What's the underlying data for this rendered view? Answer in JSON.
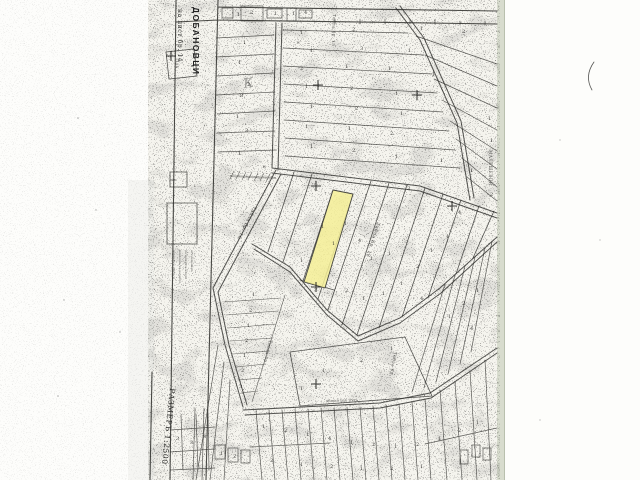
{
  "map": {
    "region_label": "ДОБАНОВЦИ",
    "sheet_label": "на лист бр. 14",
    "scale_label": "РАЗМЕРЪ 1:2500",
    "neighbor_label": "МАЛЕШЕВЦИ",
    "road_label": "общински пъть",
    "benchmark_label": "1484",
    "handwritten_mark": "К",
    "highlight_color": "#f4ef97",
    "highlight_stroke": "#44443e",
    "paper_color": "#f5f4ee",
    "scan_edge_color": "#d8dcce",
    "ink_color": "#2b2b28",
    "block_labels": [
      {
        "t": "Табла бр. 15",
        "x": 333,
        "y": 14,
        "r": 92,
        "s": 4.2
      },
      {
        "t": "Табла бр. 16",
        "x": 254,
        "y": 206,
        "r": 117,
        "s": 4.8
      },
      {
        "t": "Табла бр. 18",
        "x": 377,
        "y": 222,
        "r": 107,
        "s": 4.8
      },
      {
        "t": "Табла бр.",
        "x": 269,
        "y": 340,
        "r": 103,
        "s": 4.2
      },
      {
        "t": "Табла бр.",
        "x": 394,
        "y": 352,
        "r": 100,
        "s": 4.2
      }
    ],
    "legend_note_lines": [
      "планътъ е снетъ и",
      "нанесенъ въ размѣръ",
      "по межди и имоти",
      "отъ земемѣра"
    ],
    "crosses": [
      [
        318,
        85
      ],
      [
        417,
        95
      ],
      [
        316,
        186
      ],
      [
        316,
        287
      ],
      [
        316,
        384
      ],
      [
        171,
        56
      ],
      [
        452,
        206
      ]
    ],
    "parcel_numbers": [
      [
        300,
        34,
        "1"
      ],
      [
        352,
        31,
        "2"
      ],
      [
        420,
        30,
        "1"
      ],
      [
        462,
        33,
        "2"
      ],
      [
        310,
        52,
        "1"
      ],
      [
        360,
        50,
        "3"
      ],
      [
        408,
        52,
        "1"
      ],
      [
        300,
        70,
        "2"
      ],
      [
        345,
        68,
        "1"
      ],
      [
        388,
        70,
        "1"
      ],
      [
        432,
        76,
        "1"
      ],
      [
        305,
        88,
        "1"
      ],
      [
        350,
        90,
        "2"
      ],
      [
        395,
        95,
        "1"
      ],
      [
        310,
        108,
        "1"
      ],
      [
        355,
        110,
        "2"
      ],
      [
        400,
        115,
        "1"
      ],
      [
        305,
        128,
        "1"
      ],
      [
        348,
        130,
        "1"
      ],
      [
        390,
        135,
        "2"
      ],
      [
        310,
        148,
        "1"
      ],
      [
        352,
        152,
        "2"
      ],
      [
        395,
        158,
        "1"
      ],
      [
        440,
        162,
        "1"
      ],
      [
        470,
        172,
        "1"
      ],
      [
        488,
        120,
        "1"
      ],
      [
        490,
        142,
        "1"
      ],
      [
        407,
        190,
        "3"
      ],
      [
        490,
        196,
        "2"
      ],
      [
        458,
        214,
        "4"
      ],
      [
        243,
        44,
        "1"
      ],
      [
        238,
        64,
        "1"
      ],
      [
        247,
        86,
        "2"
      ],
      [
        240,
        97,
        "8"
      ],
      [
        236,
        118,
        "1"
      ],
      [
        245,
        132,
        "3"
      ],
      [
        238,
        155,
        "1"
      ],
      [
        237,
        16,
        "1"
      ],
      [
        250,
        14,
        "2"
      ],
      [
        274,
        15,
        "1"
      ],
      [
        292,
        15,
        "1"
      ],
      [
        304,
        14,
        "4"
      ],
      [
        344,
        225,
        "1"
      ],
      [
        332,
        245,
        "1"
      ],
      [
        358,
        242,
        "4"
      ],
      [
        370,
        260,
        "1"
      ],
      [
        388,
        255,
        "1"
      ],
      [
        345,
        292,
        "2"
      ],
      [
        362,
        300,
        "1"
      ],
      [
        382,
        295,
        "1"
      ],
      [
        400,
        285,
        "1"
      ],
      [
        416,
        268,
        "2"
      ],
      [
        430,
        252,
        "1"
      ],
      [
        446,
        238,
        "1"
      ],
      [
        420,
        300,
        "4"
      ],
      [
        300,
        262,
        "1"
      ],
      [
        321,
        228,
        "1"
      ],
      [
        252,
        296,
        "1"
      ],
      [
        249,
        312,
        "2"
      ],
      [
        247,
        327,
        "1"
      ],
      [
        245,
        342,
        "2"
      ],
      [
        243,
        357,
        "1"
      ],
      [
        241,
        372,
        "2"
      ],
      [
        239,
        388,
        "3"
      ],
      [
        322,
        372,
        "1"
      ],
      [
        360,
        362,
        "2"
      ],
      [
        300,
        390,
        "1"
      ],
      [
        390,
        350,
        "1"
      ],
      [
        448,
        318,
        "1"
      ],
      [
        462,
        305,
        "2"
      ],
      [
        476,
        292,
        "1"
      ],
      [
        470,
        330,
        "4"
      ],
      [
        262,
        428,
        "1"
      ],
      [
        284,
        432,
        "2"
      ],
      [
        306,
        436,
        "1"
      ],
      [
        328,
        440,
        "4"
      ],
      [
        350,
        444,
        "1"
      ],
      [
        372,
        446,
        "2"
      ],
      [
        394,
        448,
        "1"
      ],
      [
        416,
        446,
        "2"
      ],
      [
        438,
        440,
        "1"
      ],
      [
        458,
        432,
        "2"
      ],
      [
        476,
        424,
        "1"
      ],
      [
        270,
        462,
        "3"
      ],
      [
        300,
        466,
        "1"
      ],
      [
        330,
        468,
        "2"
      ],
      [
        360,
        470,
        "1"
      ],
      [
        390,
        470,
        "2"
      ],
      [
        420,
        468,
        "1"
      ],
      [
        176,
        440,
        "3"
      ],
      [
        190,
        444,
        "3"
      ],
      [
        203,
        438,
        "8"
      ],
      [
        220,
        455,
        "1"
      ],
      [
        233,
        458,
        "2"
      ],
      [
        262,
        168,
        "×"
      ],
      [
        296,
        44,
        "×"
      ]
    ]
  }
}
